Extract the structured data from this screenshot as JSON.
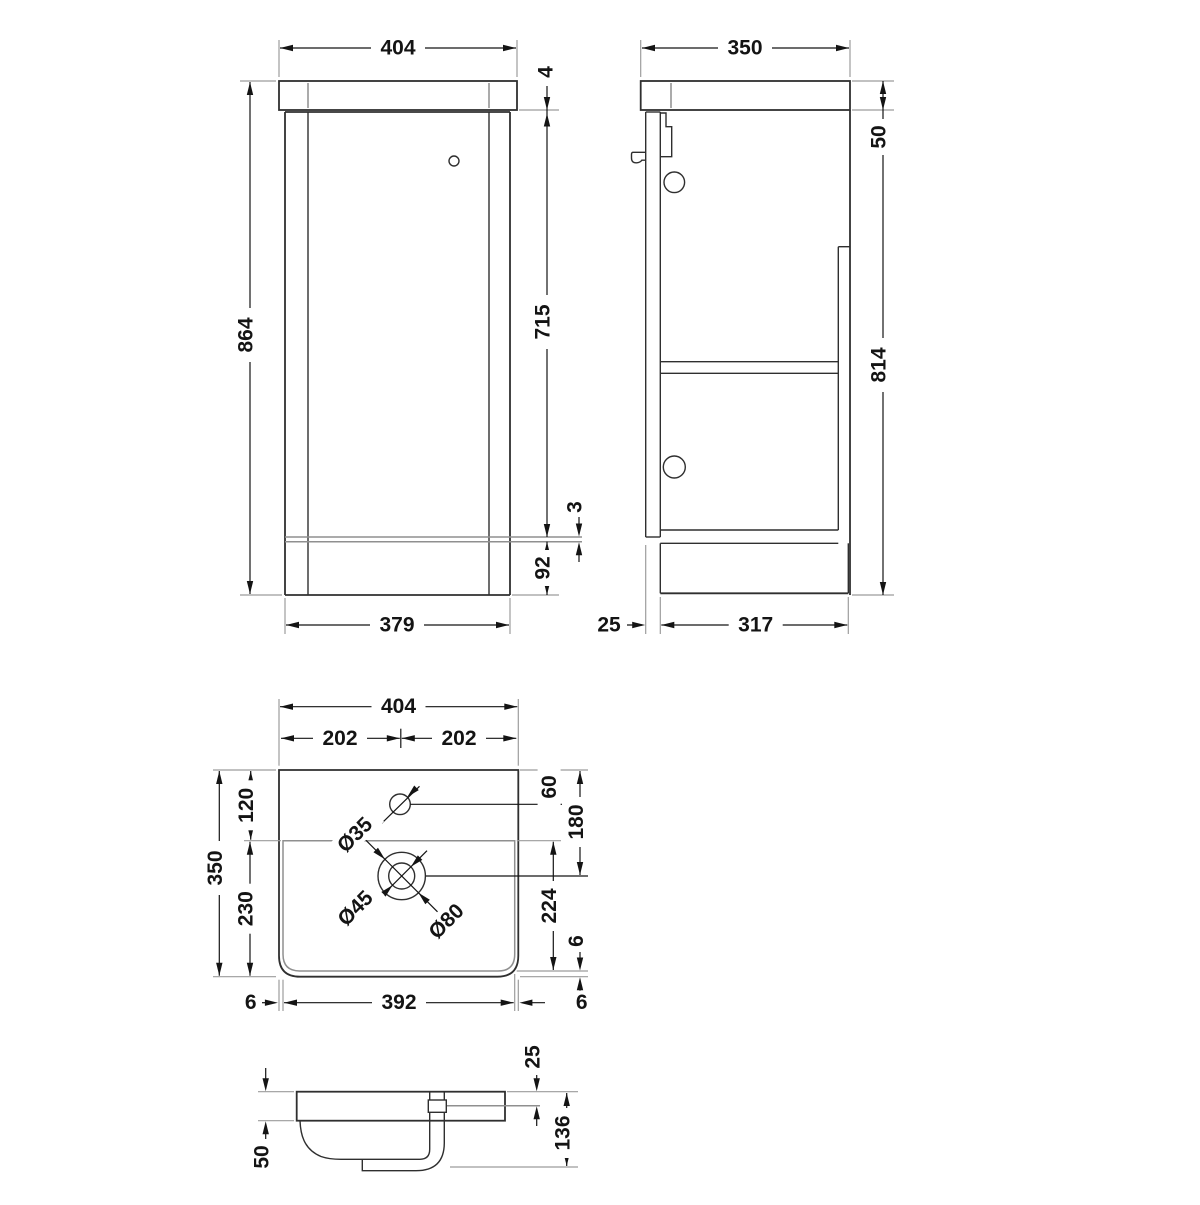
{
  "drawing": {
    "title": "vanity-unit-technical-drawing",
    "front": {
      "width_top": "404",
      "top_lip": "4",
      "overall_height": "864",
      "body_height": "715",
      "plinth_reveal": "3",
      "plinth_height": "92",
      "width_bottom": "379"
    },
    "side": {
      "depth_top": "350",
      "worktop_thickness": "50",
      "carcass_height": "814",
      "door_thickness": "25",
      "carcass_depth": "317"
    },
    "plan": {
      "overall_width": "404",
      "centre_left": "202",
      "centre_right": "202",
      "deck_depth": "120",
      "bowl_front_depth": "230",
      "overall_depth": "350",
      "tap_centre": "60",
      "waste_centre": "180",
      "bowl_length": "224",
      "bowl_edge_gap": "6",
      "rim_left": "6",
      "bowl_width": "392",
      "rim_right": "6",
      "tap_hole_dia": "Ø35",
      "waste_dia": "Ø45",
      "waste_flange_dia": "Ø80"
    },
    "section": {
      "rim_to_overflow": "25",
      "overall_height": "136",
      "bowl_depth": "50"
    },
    "colors": {
      "object_line": "#2f2f2f",
      "dimension_line": "#141414",
      "extension_line": "#9c9c9c",
      "hidden_line": "#8f8f8f",
      "background": "#ffffff"
    }
  }
}
